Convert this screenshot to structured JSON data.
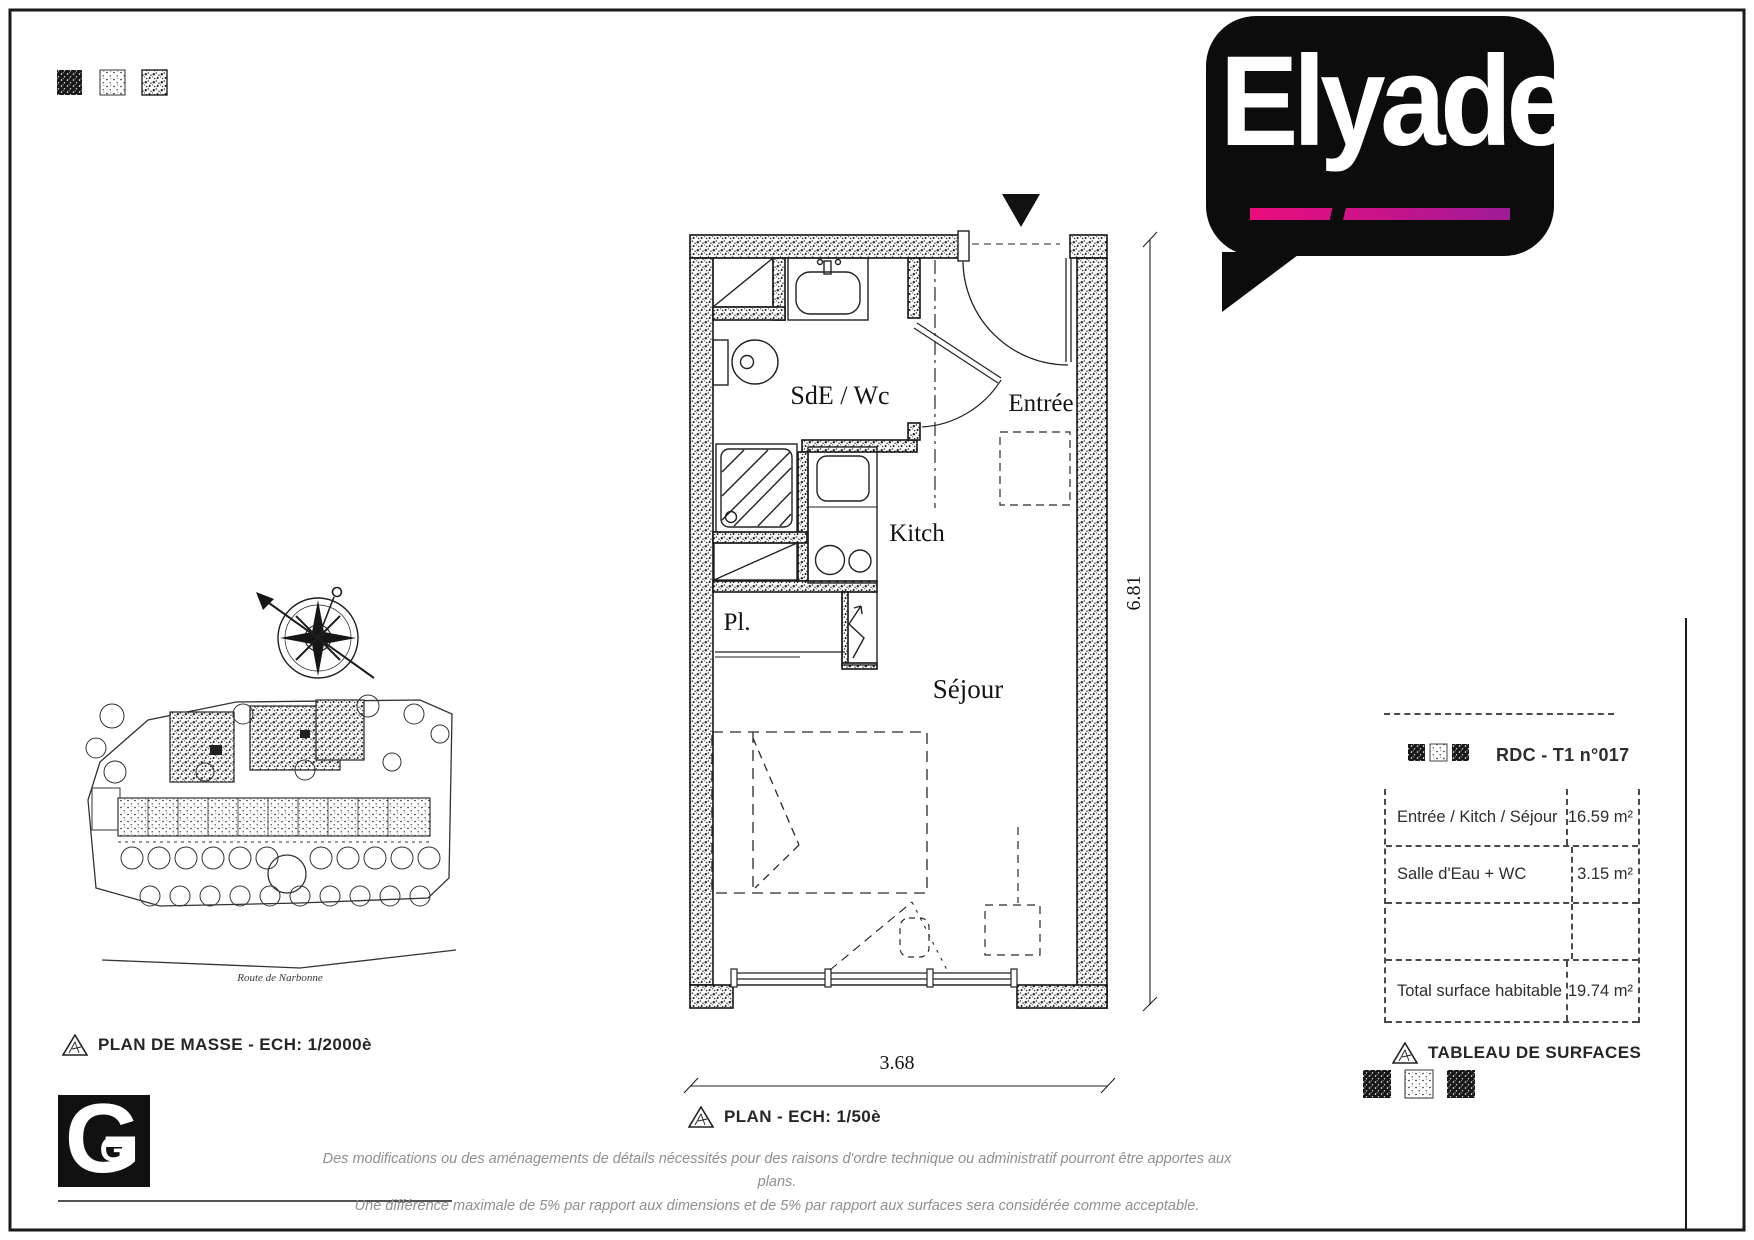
{
  "logo": {
    "brand": "Elyade",
    "accent_pink": "#ea0d7c",
    "accent_purple": "#9e1b97"
  },
  "floor_plan": {
    "caption": "PLAN - ECH: 1/50è",
    "rooms": {
      "bathroom": "SdE / Wc",
      "entrance": "Entrée",
      "kitchen": "Kitch",
      "closet": "Pl.",
      "living": "Séjour"
    },
    "dim_width": "3.68",
    "dim_height": "6.81"
  },
  "site_plan": {
    "caption": "PLAN DE MASSE - ECH: 1/2000è",
    "street": "Route de Narbonne"
  },
  "surface_table": {
    "caption": "TABLEAU DE SURFACES",
    "header": "RDC - T1 n°017",
    "rows": [
      {
        "label": "Entrée / Kitch / Séjour",
        "value": "16.59 m²"
      },
      {
        "label": "Salle d'Eau + WC",
        "value": "3.15 m²"
      }
    ],
    "total": {
      "label": "Total surface habitable",
      "value": "19.74 m²"
    }
  },
  "g_logo": {
    "letter": "G",
    "small_letter": "G"
  },
  "disclaimer": {
    "line1": "Des modifications ou des aménagements de détails nécessités pour des raisons d'ordre technique ou administratif pourront être apportes aux plans.",
    "line2": "Une différence maximale de 5% par rapport aux dimensions et de 5% par rapport aux surfaces sera considérée comme acceptable."
  }
}
